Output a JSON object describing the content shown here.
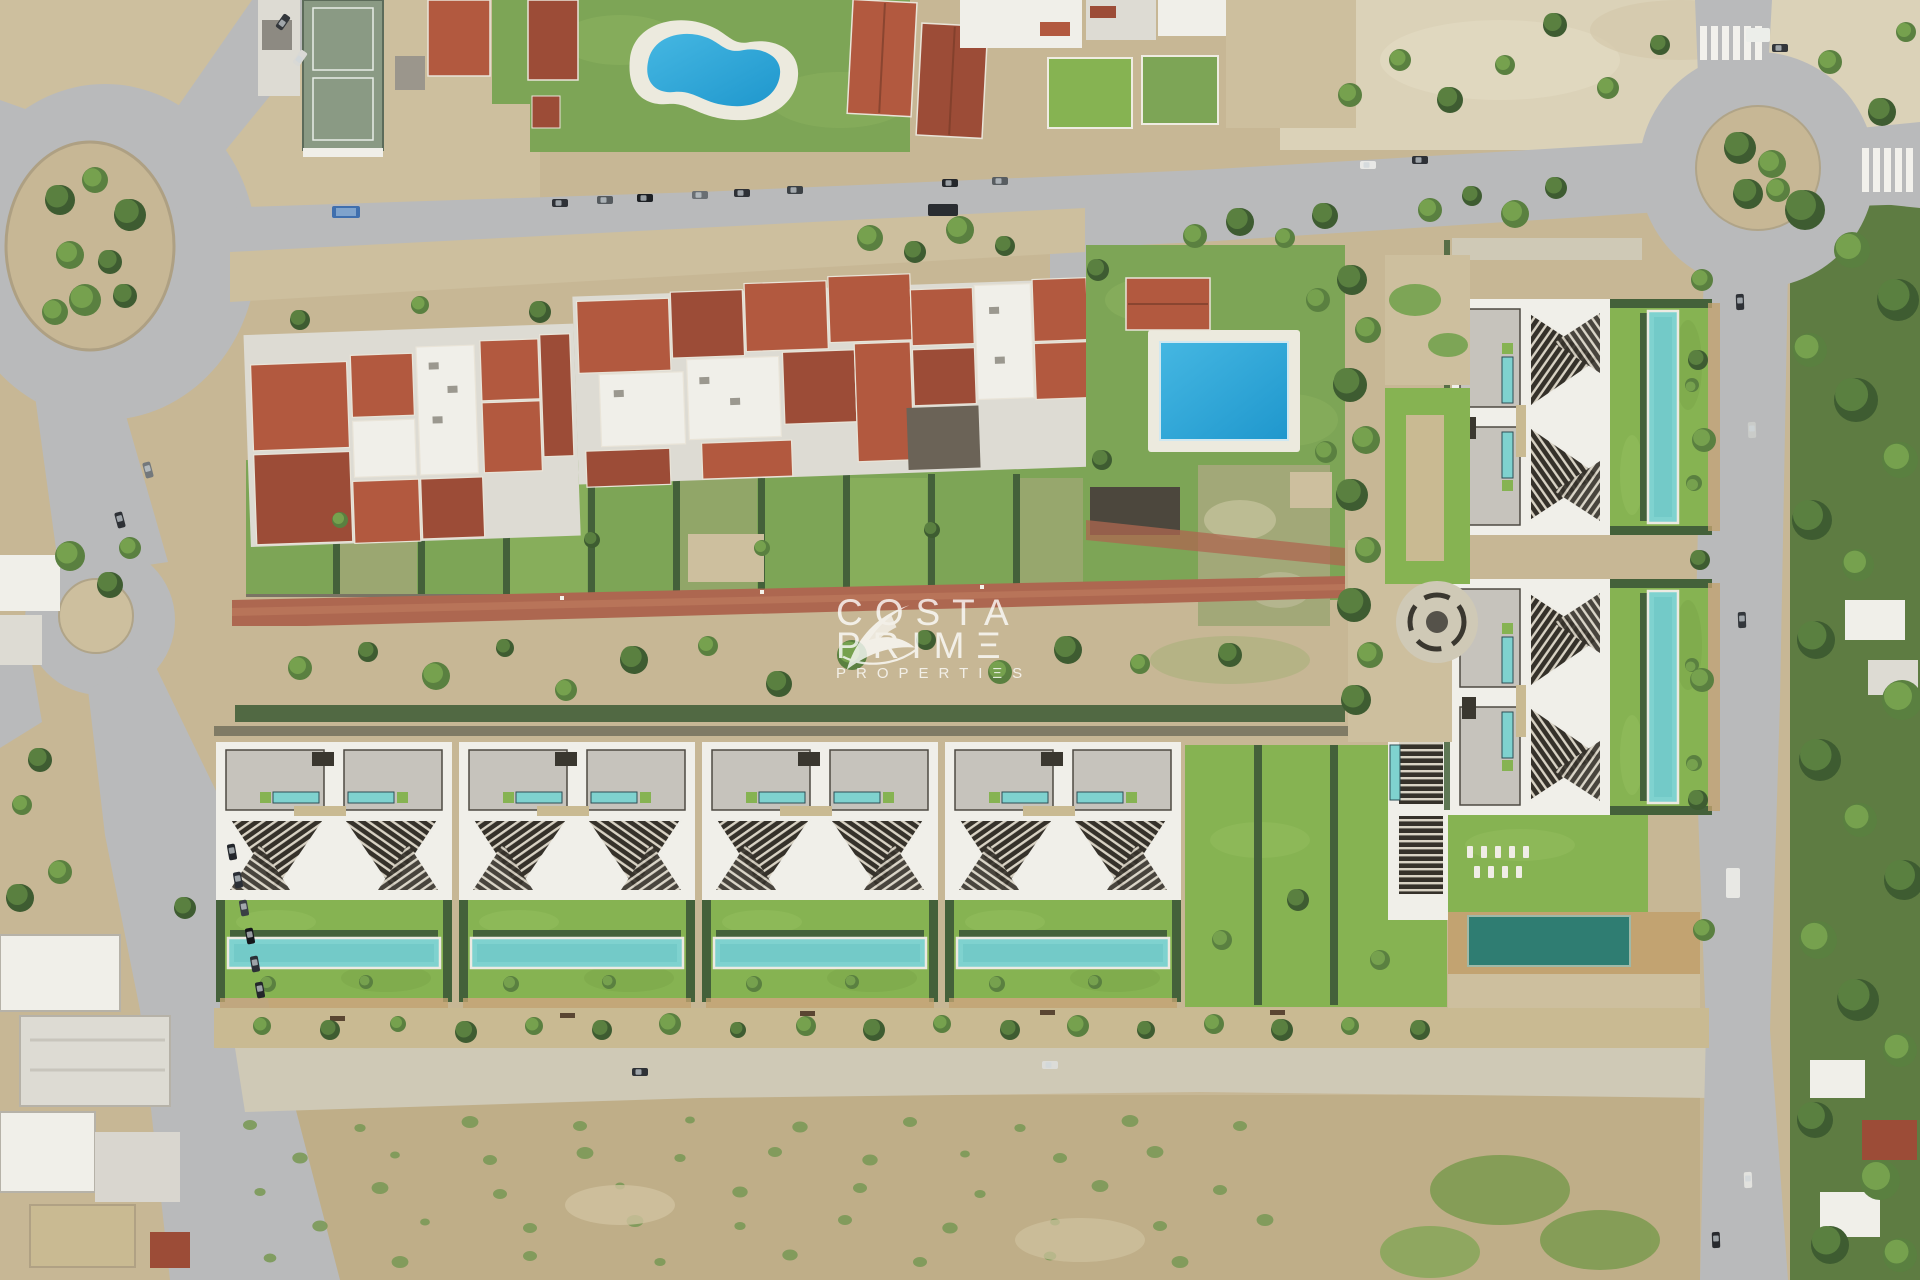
{
  "image": {
    "kind": "aerial-drone-photograph",
    "description": "Top-down aerial photo of a Mediterranean residential area: existing red-roof apartment compound with gardens, a kidney-shaped public pool and a rectangular public pool, road network with two large roundabouts and a small junction circle, and a CGI-rendered new development of modern flat-roof villas with louvred pergolas, private lap pools and landscaped lawns; scrubland in the foreground and a tree-lined road on the right.",
    "width_px": 1920,
    "height_px": 1280
  },
  "watermark": {
    "logo": "swoosh-bird-logo",
    "line1": "COSTA",
    "line2": "PRIMΞ",
    "line3": "PROPERTIΞS",
    "color": "#ffffff",
    "opacity": 0.78
  },
  "palette": {
    "road": "#b9babb",
    "roadL": "#cfc9b6",
    "dirt": "#c7b795",
    "dirt2": "#cdbf9e",
    "sand": "#dbd2b8",
    "scrub": "#bfae88",
    "grass": "#7da556",
    "grassB": "#86b352",
    "grassW": "#a2a878",
    "hedge": "#44613a",
    "brick": "#ad6750",
    "redroof": "#b2593f",
    "redroof2": "#9c4c37",
    "white": "#f0efe9",
    "whiteD": "#dddbd3",
    "gravel": "#c6c3bc",
    "wood": "#c9ba92",
    "woodD": "#c2a371",
    "poolT": "#7fd2cf",
    "poolD": "#2f7d72",
    "court": "#8a9a84",
    "dark": "#3a372f",
    "bush": "#7c9a58",
    "water1": "#45b7e2",
    "water2": "#1f97cd",
    "treeDark": "#3e5c31",
    "treeMid": "#5a8040",
    "treeLight": "#76a14e",
    "slatDark": "#35312a",
    "slatLight": "#d8d2c4",
    "wm": "#ffffff"
  },
  "scene": {
    "landmarks": [
      "top-left-roundabout",
      "top-right-roundabout",
      "small-junction-circle",
      "main-east-west-road",
      "right-vertical-road",
      "south-access-road",
      "tennis-court",
      "kidney-shaped-pool",
      "rectangular-public-pool",
      "red-roof-apartment-compound",
      "garden-plots",
      "brick-walkway",
      "new-villa-row-of-4-blocks",
      "right-villa-column-of-2-blocks",
      "communal-lawn-with-sunloungers",
      "communal-deck-pool",
      "circular-paved-feature",
      "scrubland-foreground",
      "industrial-white-buildings",
      "tree-lined-east-road",
      "pedestrian-crossings",
      "parked-cars"
    ],
    "counts": {
      "villa_blocks_bottom_row": 4,
      "villa_blocks_right_column": 2,
      "public_pools": 2,
      "roundabouts": 2
    }
  }
}
